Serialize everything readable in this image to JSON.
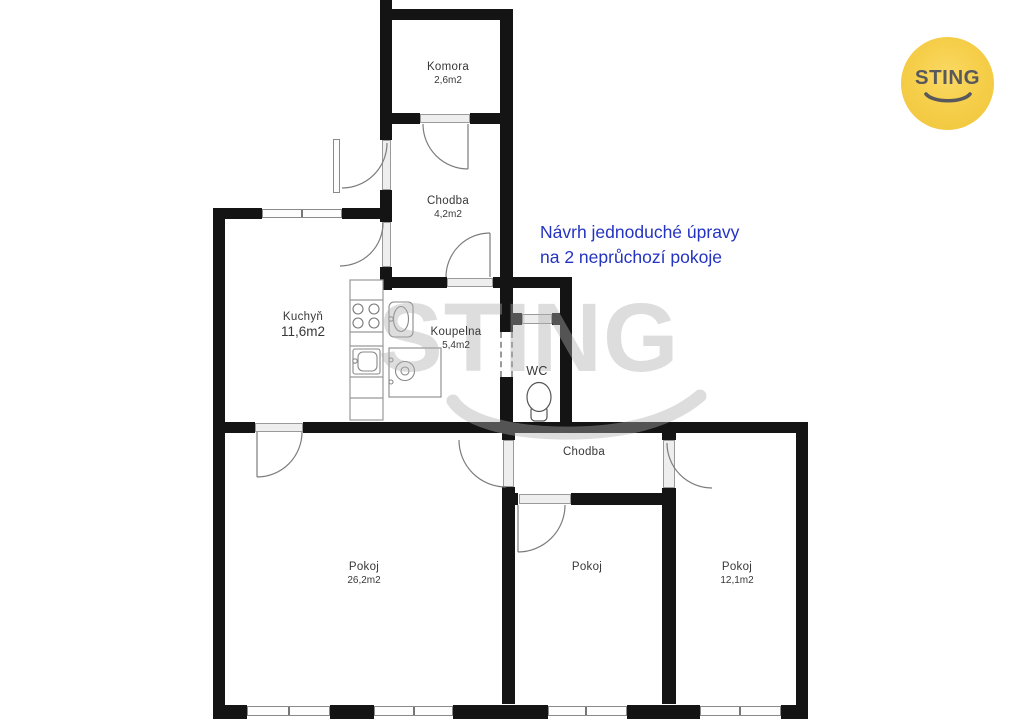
{
  "logo": {
    "text": "STING",
    "circle_color": "#f5cc43",
    "text_color": "#59585c"
  },
  "watermark": {
    "text": "STING"
  },
  "annotation": {
    "line1": "Návrh jednoduché úpravy",
    "line2": "na 2 neprůchozí pokoje",
    "color": "#2433c0"
  },
  "rooms": {
    "komora": {
      "label": "Komora",
      "area": "2,6m2"
    },
    "chodba_upper": {
      "label": "Chodba",
      "area": "4,2m2"
    },
    "kuchyn": {
      "label": "Kuchyň",
      "area": "11,6m2"
    },
    "koupelna": {
      "label": "Koupelna",
      "area": "5,4m2"
    },
    "wc": {
      "label": "WC"
    },
    "chodba_lower": {
      "label": "Chodba"
    },
    "pokoj_large": {
      "label": "Pokoj",
      "area": "26,2m2"
    },
    "pokoj_middle": {
      "label": "Pokoj"
    },
    "pokoj_right": {
      "label": "Pokoj",
      "area": "12,1m2"
    }
  }
}
